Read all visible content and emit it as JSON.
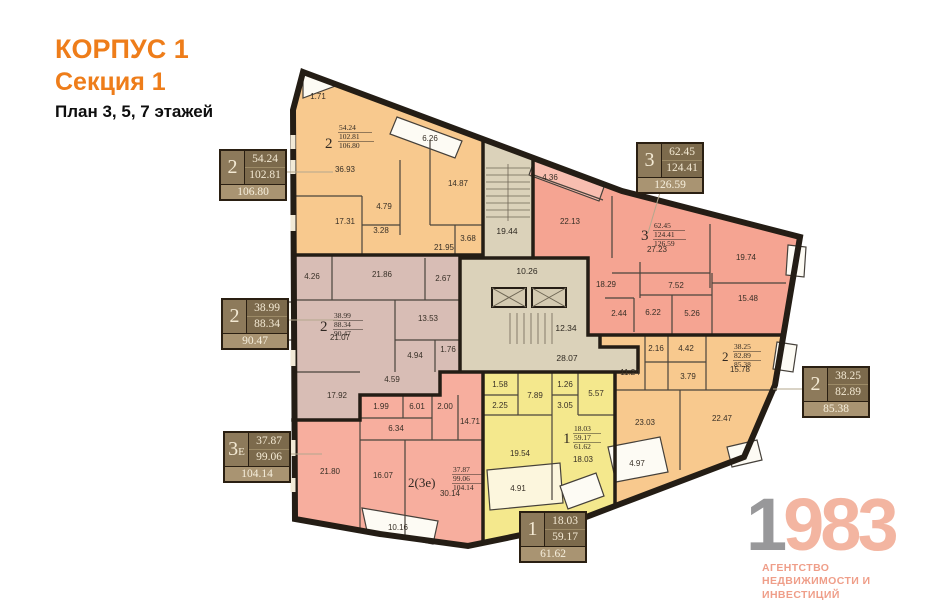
{
  "title": {
    "korpus": "КОРПУС 1",
    "sektsiya": "Секция 1",
    "plan": "План 3, 5, 7 этажей"
  },
  "callouts": [
    {
      "num": "2",
      "sub": "",
      "living": "54.24",
      "total": "102.81",
      "total_b": "106.80"
    },
    {
      "num": "2",
      "sub": "",
      "living": "38.99",
      "total": "88.34",
      "total_b": "90.47"
    },
    {
      "num": "3",
      "sub": "Е",
      "living": "37.87",
      "total": "99.06",
      "total_b": "104.14"
    },
    {
      "num": "3",
      "sub": "",
      "living": "62.45",
      "total": "124.41",
      "total_b": "126.59"
    },
    {
      "num": "2",
      "sub": "",
      "living": "38.25",
      "total": "82.89",
      "total_b": "85.38"
    },
    {
      "num": "1",
      "sub": "",
      "living": "18.03",
      "total": "59.17",
      "total_b": "61.62"
    }
  ],
  "apartments": [
    {
      "label": {
        "num": "2",
        "living": "54.24",
        "total": "102.81",
        "total_b": "106.80"
      },
      "rooms": [
        "36.93",
        "17.31",
        "14.87",
        "4.79",
        "3.28",
        "21.95",
        "3.68"
      ],
      "balconies": [
        "1.71",
        "6.26"
      ]
    },
    {
      "label": {
        "num": "2",
        "living": "38.99",
        "total": "88.34",
        "total_b": "90.47"
      },
      "rooms": [
        "21.86",
        "21.07",
        "17.92",
        "13.53",
        "4.94",
        "4.59",
        "2.67",
        "1.76"
      ],
      "balconies": [
        "4.26"
      ]
    },
    {
      "label": {
        "num": "2(3е)",
        "living": "37.87",
        "total": "99.06",
        "total_b": "104.14"
      },
      "rooms": [
        "21.80",
        "16.07",
        "30.14",
        "14.71",
        "6.34",
        "6.01",
        "1.99",
        "2.00"
      ],
      "balconies": [
        "10.16"
      ]
    },
    {
      "label": {
        "num": "1",
        "living": "18.03",
        "total": "59.17",
        "total_b": "61.62"
      },
      "rooms": [
        "19.54",
        "18.03",
        "7.89",
        "5.57",
        "3.05",
        "2.25",
        "1.58",
        "1.26"
      ],
      "balconies": [
        "4.91"
      ]
    },
    {
      "label": {
        "num": "3",
        "living": "62.45",
        "total": "124.41",
        "total_b": "126.59"
      },
      "rooms": [
        "27.23",
        "22.13",
        "19.74",
        "18.29",
        "15.48",
        "7.52",
        "6.22",
        "5.26",
        "2.44"
      ],
      "balconies": [
        "4.36"
      ]
    },
    {
      "label": {
        "num": "2",
        "living": "38.25",
        "total": "82.89",
        "total_b": "85.38"
      },
      "rooms": [
        "23.03",
        "22.47",
        "15.78",
        "11.24",
        "4.42",
        "3.79",
        "2.16"
      ],
      "balconies": [
        "4.97"
      ]
    }
  ],
  "core": {
    "rooms": [
      "19.44",
      "10.26",
      "12.34",
      "28.07"
    ]
  },
  "colors": {
    "orange": "#f8c98e",
    "pink": "#f5a492",
    "salmon": "#f7ae9e",
    "mauve": "#d8bdb5",
    "yellow": "#f4e88d",
    "core": "#dbd2ba",
    "wall": "#241d15",
    "title_accent": "#ee7d1a",
    "callout_dark": "#7c6a4c",
    "callout_light": "#a99472",
    "logo_accent": "#f3b5a1"
  },
  "logo": {
    "year_gray": "1",
    "year_accent": "983",
    "line1": "АГЕНТСТВО",
    "line2": "НЕДВИЖИМОСТИ И ИНВЕСТИЦИЙ"
  }
}
